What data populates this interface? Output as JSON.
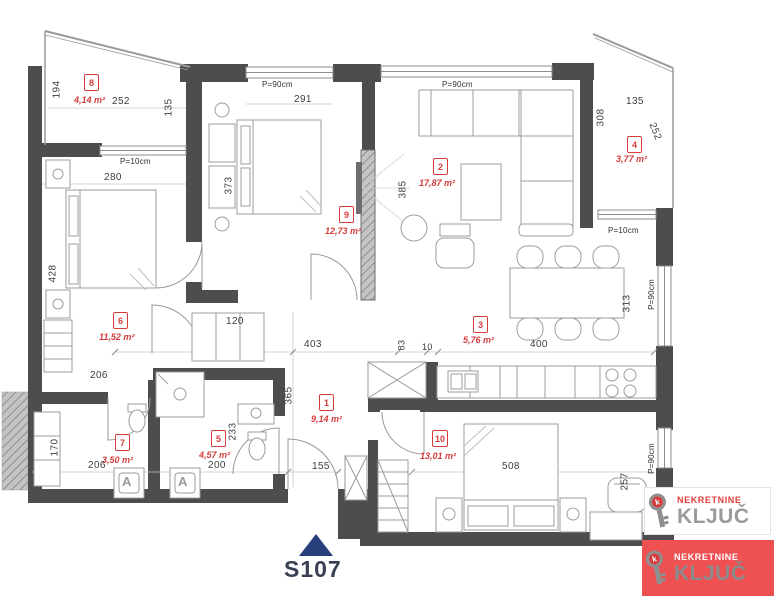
{
  "unit": {
    "code": "S107"
  },
  "colors": {
    "wall": "#4d4d4d",
    "accent_red": "#d43c3c",
    "logo_red": "#ef5052",
    "arrow_navy": "#27407c"
  },
  "rooms": [
    {
      "num": "1",
      "area": "9,14 m²"
    },
    {
      "num": "2",
      "area": "17,87 m²"
    },
    {
      "num": "3",
      "area": "5,76 m²"
    },
    {
      "num": "4",
      "area": "3,77 m²"
    },
    {
      "num": "5",
      "area": "4,57 m²"
    },
    {
      "num": "6",
      "area": "11,52 m²"
    },
    {
      "num": "7",
      "area": "3,50 m²"
    },
    {
      "num": "8",
      "area": "4,14 m²"
    },
    {
      "num": "9",
      "area": "12,73 m²"
    },
    {
      "num": "10",
      "area": "13,01 m²"
    }
  ],
  "dims": {
    "d194": "194",
    "d252_t8": "252",
    "d135_t8": "135",
    "d280": "280",
    "d291": "291",
    "d373": "373",
    "d385": "385",
    "d135_t4": "135",
    "d308": "308",
    "d252_t4": "252",
    "d428": "428",
    "d206_r6": "206",
    "d120": "120",
    "d365": "365",
    "d403": "403",
    "d83": "83",
    "d10": "10",
    "d400": "400",
    "d313": "313",
    "d170": "170",
    "d206_r7": "206",
    "d200": "200",
    "d233": "233",
    "d155": "155",
    "d508": "508",
    "d257": "257"
  },
  "windows": {
    "p90": "P=90cm",
    "p10": "P=10cm"
  },
  "labels": {
    "appliance": "A"
  },
  "logo": {
    "line1": "NEKRETNINE",
    "line2": "KLJUČ",
    "key_letter": "k"
  }
}
